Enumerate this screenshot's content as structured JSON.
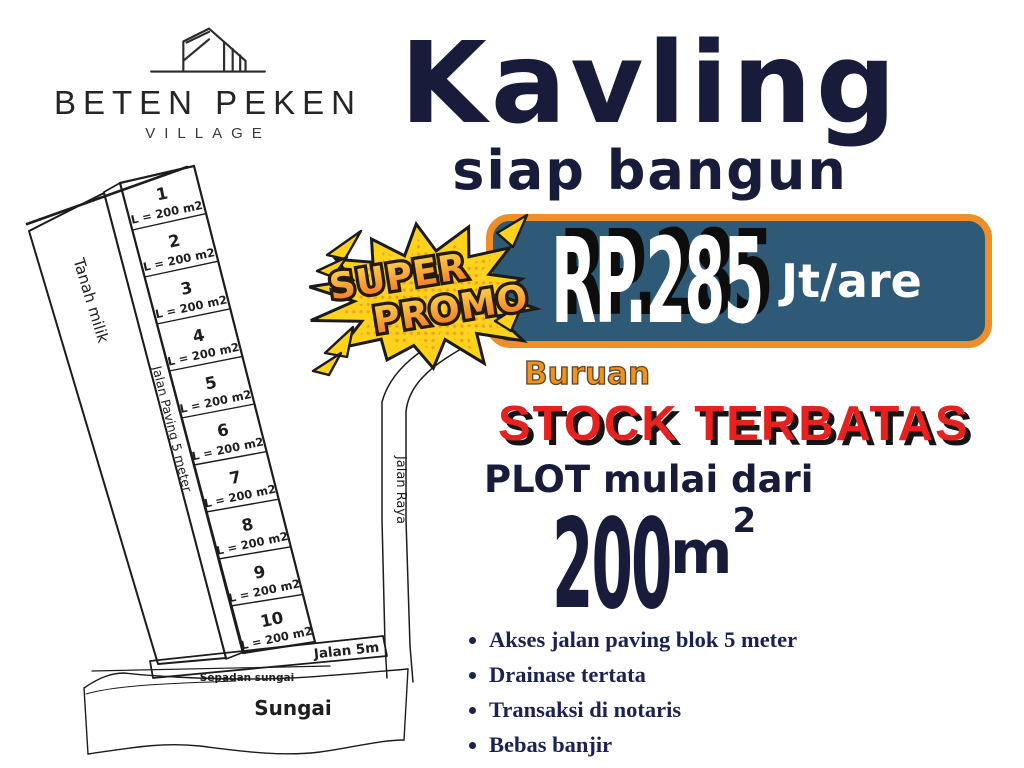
{
  "logo": {
    "name": "BETEN PEKEN",
    "subtitle": "VILLAGE",
    "icon": "building-icon"
  },
  "headline": {
    "title": "Kavling",
    "subtitle": "siap bangun"
  },
  "promo_badge": {
    "line1": "SUPER",
    "line2": "PROMO"
  },
  "price_banner": {
    "amount": "RP.285",
    "unit": "Jt/are"
  },
  "urgency": {
    "lead": "Buruan",
    "main": "STOCK TERBATAS"
  },
  "plot_offer": {
    "lead": "PLOT mulai dari",
    "size": "200",
    "unit": "m",
    "unit_sup": "2"
  },
  "features": [
    "Akses jalan paving blok 5 meter",
    "Drainase tertata",
    "Transaksi di notaris",
    "Bebas banjir"
  ],
  "site_plan": {
    "plots": [
      {
        "no": "1",
        "area": "L = 200 m2"
      },
      {
        "no": "2",
        "area": "L = 200 m2"
      },
      {
        "no": "3",
        "area": "L = 200 m2"
      },
      {
        "no": "4",
        "area": "L = 200 m2"
      },
      {
        "no": "5",
        "area": "L = 200 m2"
      },
      {
        "no": "6",
        "area": "L = 200 m2"
      },
      {
        "no": "7",
        "area": "L = 200 m2"
      },
      {
        "no": "8",
        "area": "L = 200 m2"
      },
      {
        "no": "9",
        "area": "L = 200 m2"
      },
      {
        "no": "10",
        "area": "L = 200 m2"
      }
    ],
    "labels": {
      "left_parcel": "Tanah milik",
      "paving_road": "Jalan Paving 5 meter",
      "main_road": "Jalan Raya",
      "bottom_road": "Jalan 5m",
      "river_margin": "Sepadan sungai",
      "river": "Sungai"
    }
  },
  "colors": {
    "navy": "#181b3a",
    "navy2": "#1b2150",
    "orange": "#ef8d27",
    "orange2": "#f0921e",
    "red": "#e6211f",
    "banner_blue": "#2e5a77",
    "yellow": "#ffd21c"
  }
}
